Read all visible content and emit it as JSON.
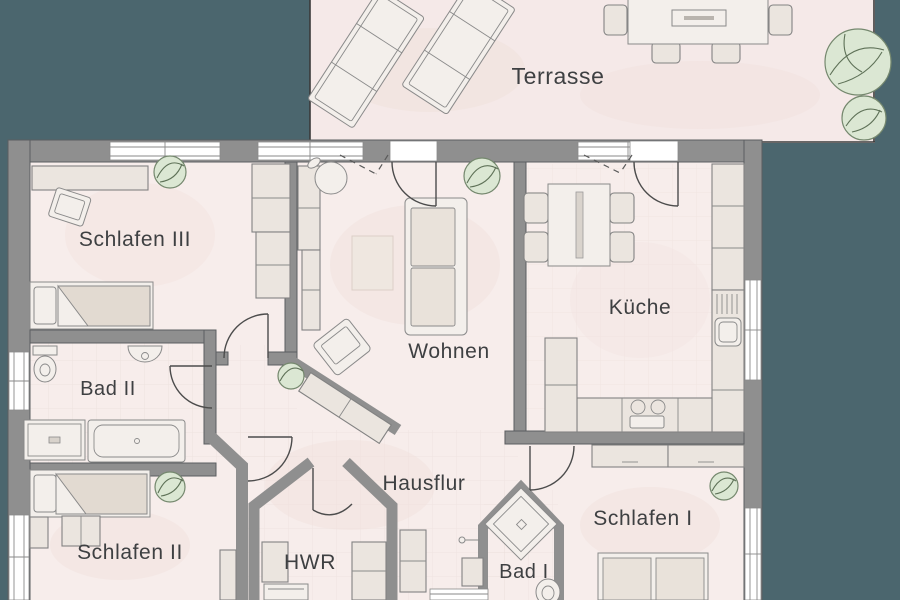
{
  "palette": {
    "background": "#4b666e",
    "wall": "#8f8f8f",
    "wall_outline": "#5b5e60",
    "floor": "#f7edeb",
    "terrace_floor": "#f5e9e8",
    "furniture": "#ebe5df",
    "furniture_light": "#f3efeb",
    "plant_fill": "#dbe7d3",
    "plant_stroke": "#75886e",
    "label_color": "#3e4042",
    "window": "#ffffff",
    "door_stroke": "#4c4c4c"
  },
  "rooms": {
    "terrasse": {
      "label": "Terrasse"
    },
    "schlafen3": {
      "label": "Schlafen III"
    },
    "wohnen": {
      "label": "Wohnen"
    },
    "kueche": {
      "label": "Küche"
    },
    "bad2": {
      "label": "Bad II"
    },
    "schlafen2": {
      "label": "Schlafen II"
    },
    "hausflur": {
      "label": "Hausflur"
    },
    "hwr": {
      "label": "HWR"
    },
    "bad1": {
      "label": "Bad I"
    },
    "schlafen1": {
      "label": "Schlafen I"
    }
  }
}
